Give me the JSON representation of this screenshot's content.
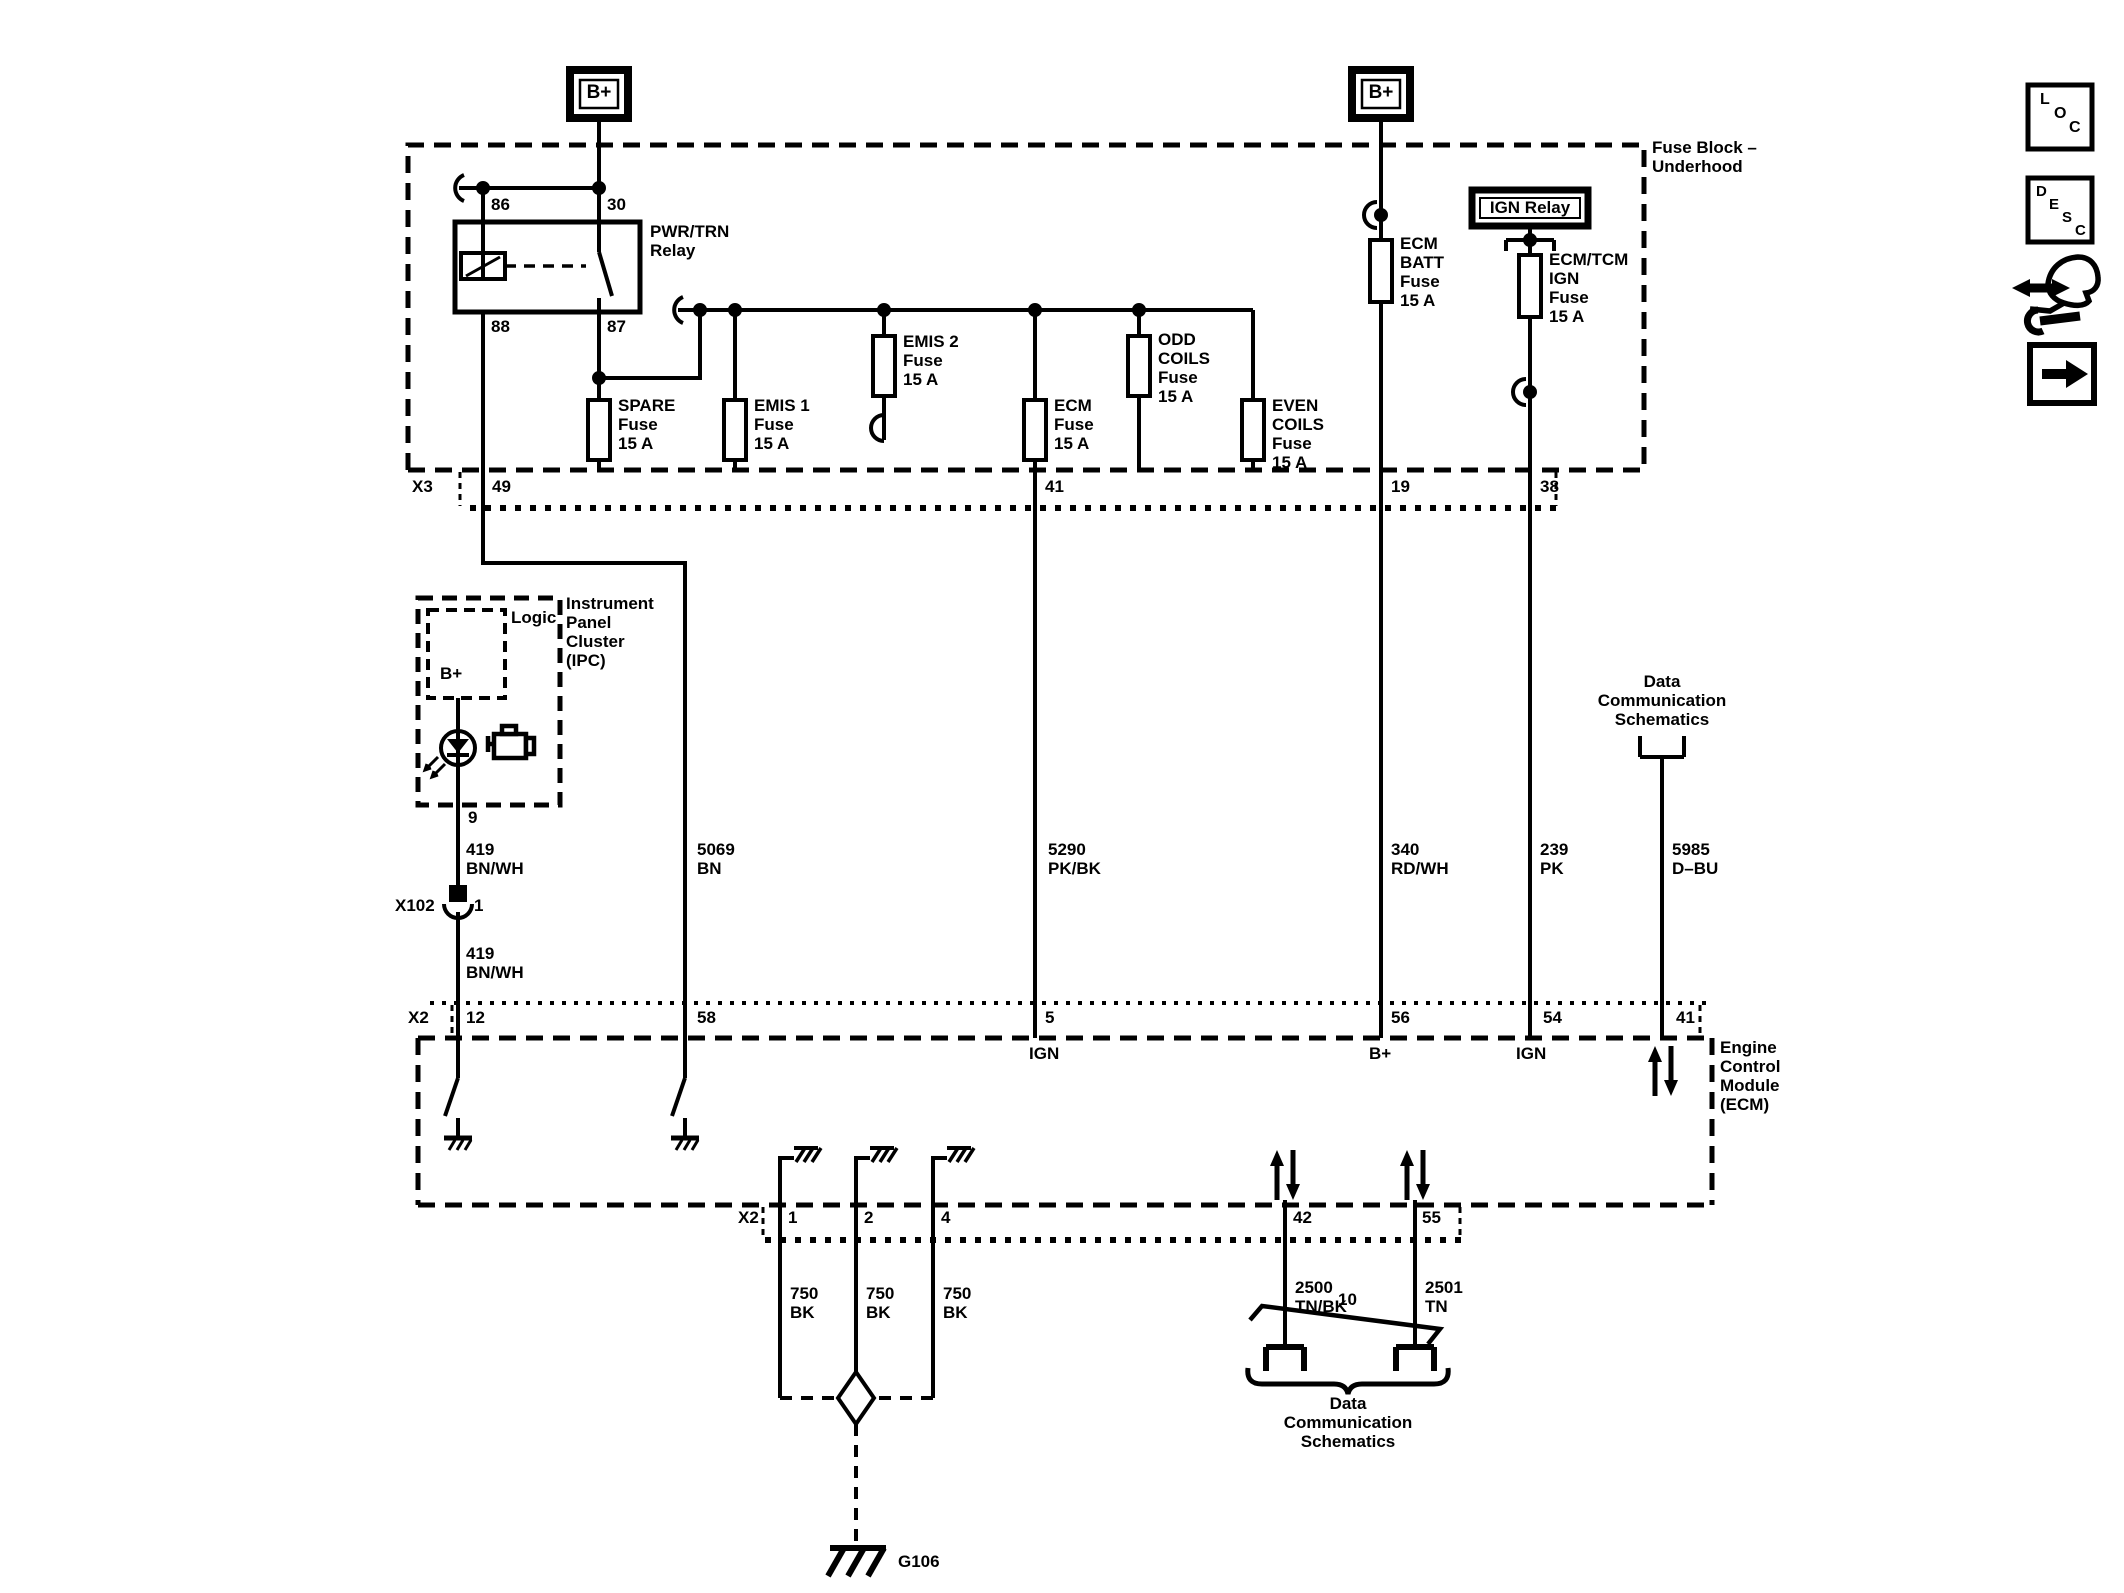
{
  "palette": {
    "ink": "#000000",
    "paper": "#ffffff"
  },
  "power": {
    "b_plus_left": "B+",
    "b_plus_right": "B+"
  },
  "fuse_block": {
    "title": "Fuse Block –\nUnderhood",
    "relay": {
      "name": "PWR/TRN\nRelay",
      "pin86": "86",
      "pin30": "30",
      "pin88": "88",
      "pin87": "87"
    },
    "ign_relay": {
      "name": "IGN Relay"
    },
    "fuses": {
      "spare": "SPARE\nFuse\n15 A",
      "emis1": "EMIS 1\nFuse\n15 A",
      "emis2": "EMIS 2\nFuse\n15 A",
      "ecm": "ECM\nFuse\n15 A",
      "odd_coils": "ODD\nCOILS\nFuse\n15 A",
      "even_coils": "EVEN\nCOILS\nFuse\n15 A",
      "ecm_batt": "ECM\nBATT\nFuse\n15 A",
      "ecm_tcm_ign": "ECM/TCM\nIGN\nFuse\n15 A"
    }
  },
  "connectors": {
    "x3": {
      "name": "X3",
      "pins": {
        "p49": "49",
        "p41": "41",
        "p19": "19",
        "p38": "38"
      }
    },
    "x102": {
      "name": "X102",
      "pin1": "1"
    },
    "x2_top": {
      "name": "X2",
      "pins": {
        "p12": "12",
        "p58": "58",
        "p5": "5",
        "p56": "56",
        "p54": "54",
        "p41": "41"
      },
      "functions": {
        "ign_5": "IGN",
        "bplus_56": "B+",
        "ign_54": "IGN"
      }
    },
    "x2_bottom": {
      "name": "X2",
      "pins": {
        "p1": "1",
        "p2": "2",
        "p4": "4",
        "p42": "42",
        "p55": "55"
      }
    }
  },
  "ipc": {
    "title": "Instrument\nPanel\nCluster\n(IPC)",
    "logic": "Logic",
    "b_plus": "B+",
    "pin9": "9"
  },
  "ecm": {
    "title": "Engine\nControl\nModule\n(ECM)"
  },
  "wires": {
    "w419_a": "419\nBN/WH",
    "w419_b": "419\nBN/WH",
    "w5069": "5069\nBN",
    "w5290": "5290\nPK/BK",
    "w340": "340\nRD/WH",
    "w239": "239\nPK",
    "w5985": "5985\nD–BU",
    "w750_1": "750\nBK",
    "w750_2": "750\nBK",
    "w750_3": "750\nBK",
    "w2500": "2500\nTN/BK",
    "w2501": "2501\nTN",
    "twist_pair_id": "10"
  },
  "grounds": {
    "g106": "G106"
  },
  "references": {
    "data_comm_top": "Data\nCommunication\nSchematics",
    "data_comm_bottom": "Data\nCommunication\nSchematics"
  },
  "nav_icons": {
    "loc": {
      "l": "L",
      "o": "O",
      "c": "C"
    },
    "desc": {
      "d": "D",
      "e": "E",
      "s": "S",
      "c": "C"
    }
  }
}
